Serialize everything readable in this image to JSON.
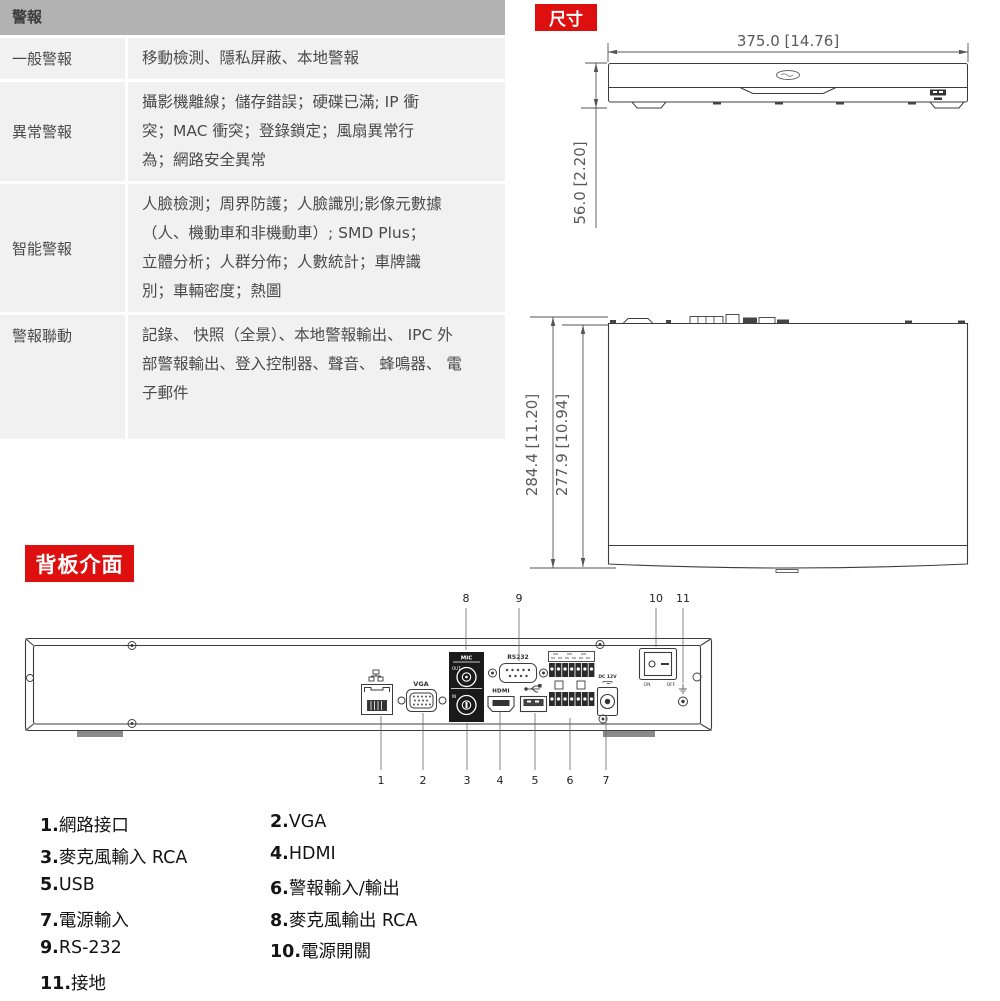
{
  "colors": {
    "badge_red": "#dd0f0f",
    "table_header_bg": "#b2b2b2",
    "table_cell_bg": "#f1f1f1",
    "table_text": "#4a4a4a",
    "drawing_line": "#3c3c3c",
    "dimension_text": "#5a5a5a"
  },
  "alarm_table": {
    "header": "警報",
    "rows": [
      {
        "label": "一般警報",
        "lines": [
          "移動檢測、隱私屏蔽、本地警報"
        ]
      },
      {
        "label": "異常警報",
        "lines": [
          "攝影機離線；儲存錯誤；硬碟已滿; IP 衝",
          "突；MAC 衝突；登錄鎖定；風扇異常行",
          "為；網路安全異常"
        ]
      },
      {
        "label": "智能警報",
        "lines": [
          "人臉檢測；周界防護；人臉識別;影像元數據",
          "（人、機動車和非機動車）; SMD Plus；",
          "立體分析；人群分佈；人數統計；車牌識",
          "別；車輛密度；熱圖"
        ]
      },
      {
        "label": "警報聯動",
        "lines": [
          "記錄、 快照（全景）、本地警報輸出、 IPC 外",
          "部警報輸出、登入控制器、聲音、 蜂鳴器、 電",
          "子郵件"
        ]
      }
    ]
  },
  "dimensions": {
    "badge": "尺寸",
    "front_view": {
      "width_dim": "375.0 [14.76]",
      "height_dim": "56.0 [2.20]"
    },
    "top_view": {
      "outer_dim": "284.4 [11.20]",
      "inner_dim": "277.9 [10.94]"
    }
  },
  "back_panel": {
    "badge": "背板介面",
    "labels": {
      "mic": "MIC",
      "out": "OUT",
      "in": "IN",
      "vga": "VGA",
      "rs232": "RS232",
      "hdmi": "HDMI",
      "dc": "DC 12V",
      "on": "ON",
      "off": "OFF"
    },
    "callouts_top": [
      "8",
      "9",
      "10",
      "11"
    ],
    "callouts_bottom": [
      "1",
      "2",
      "3",
      "4",
      "5",
      "6",
      "7"
    ],
    "legend": [
      {
        "num": "1.",
        "label": "網路接口"
      },
      {
        "num": "2.",
        "label": "VGA"
      },
      {
        "num": "3.",
        "label": "麥克風輸入 RCA"
      },
      {
        "num": "4.",
        "label": "HDMI"
      },
      {
        "num": "5.",
        "label": "USB"
      },
      {
        "num": "6.",
        "label": "警報輸入/輸出"
      },
      {
        "num": "7.",
        "label": "電源輸入"
      },
      {
        "num": "8.",
        "label": "麥克風輸出 RCA"
      },
      {
        "num": "9.",
        "label": "RS-232"
      },
      {
        "num": "10.",
        "label": "電源開關"
      },
      {
        "num": "11.",
        "label": "接地"
      }
    ]
  }
}
